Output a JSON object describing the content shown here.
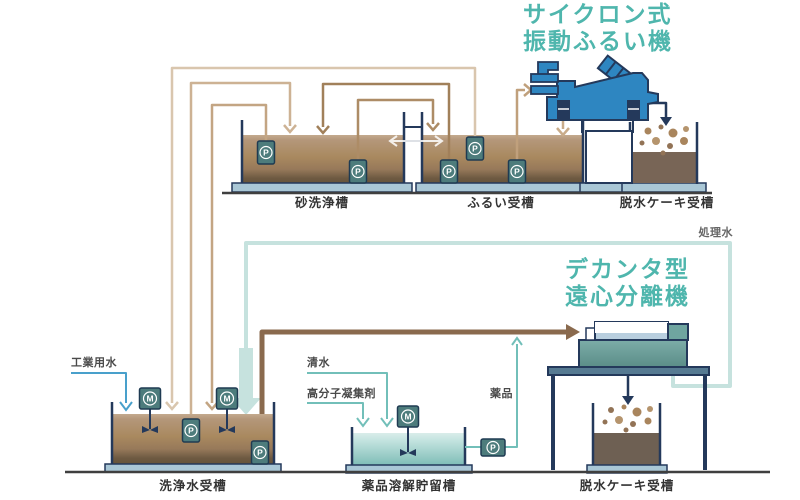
{
  "titles": {
    "sieve_machine": {
      "line1": "サイクロン式",
      "line2": "振動ふるい機"
    },
    "decanter": {
      "line1": "デカンタ型",
      "line2": "遠心分離機"
    }
  },
  "tanks": {
    "sand_washing": "砂洗浄槽",
    "sieve_receiving": "ふるい受槽",
    "cake_receiving_top": "脱水ケーキ受槽",
    "washing_water": "洗浄水受槽",
    "chemical_dissolving": "薬品溶解貯留槽",
    "cake_receiving_bottom": "脱水ケーキ受槽"
  },
  "stream_labels": {
    "industrial_water": "工業用水",
    "fresh_water": "清水",
    "polymer_flocculant": "高分子凝集剤",
    "chemical": "薬品",
    "treated_water": "処理水"
  },
  "equipment_labels": {
    "pump": "P",
    "mixer": "M"
  },
  "colors": {
    "accent_teal": "#4fb6ad",
    "navy": "#24395b",
    "machine_blue": "#2e86c1",
    "pipe_brown_thick": "#8a6a4e",
    "industrial_water_blue": "#49a0cb",
    "treated_water_pale": "#c6e2de",
    "chemical_teal": "#72bfb9",
    "tank_water_tan": "#a9895f",
    "equipment_box_teal": "#4d7c7c"
  }
}
